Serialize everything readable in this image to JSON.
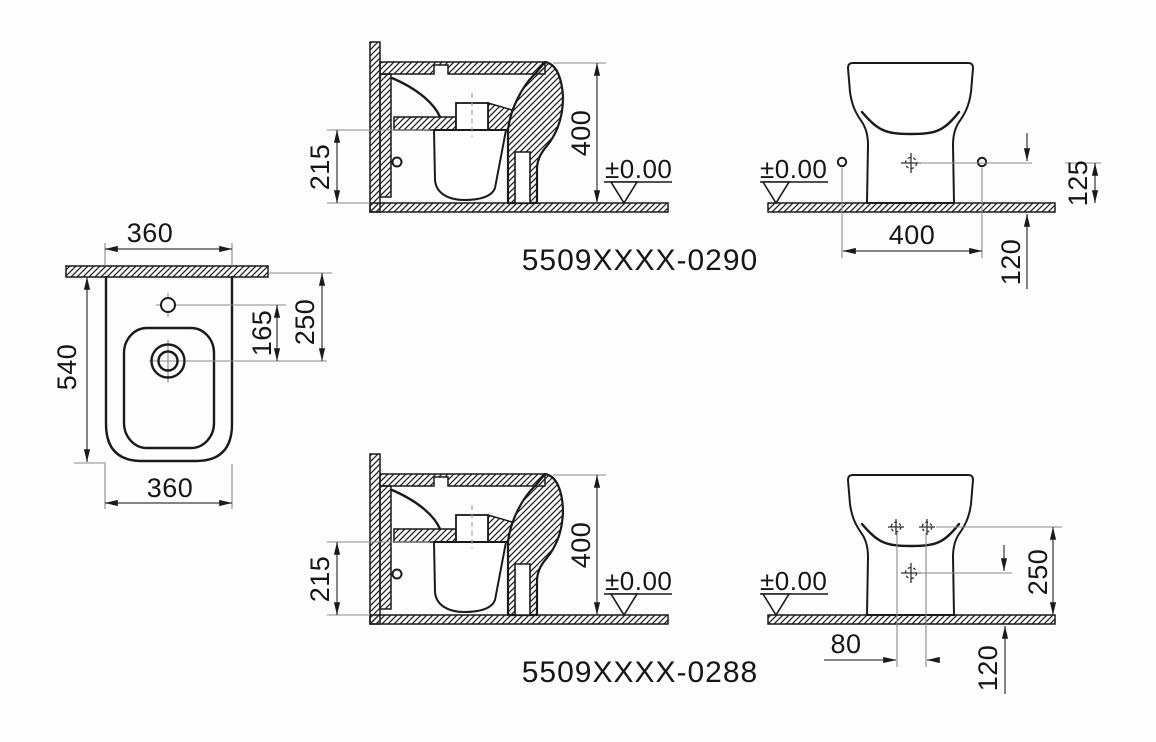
{
  "plan_view": {
    "width_top": "360",
    "depth": "540",
    "hole_offset": "165",
    "wall_to_drain": "250",
    "width_bottom": "360"
  },
  "side_views": [
    {
      "rim_height": "215",
      "overall_height": "400",
      "floor_level": "±0.00",
      "model_code": "5509XXXX-0290"
    },
    {
      "rim_height": "215",
      "overall_height": "400",
      "floor_level": "±0.00",
      "model_code": "5509XXXX-0288"
    }
  ],
  "rear_views": [
    {
      "floor_level": "±0.00",
      "hole_spacing": "400",
      "hole_height": "125",
      "drain_height": "120"
    },
    {
      "floor_level": "±0.00",
      "hole_spacing": "80",
      "hole_height": "250",
      "drain_height": "120"
    }
  ]
}
